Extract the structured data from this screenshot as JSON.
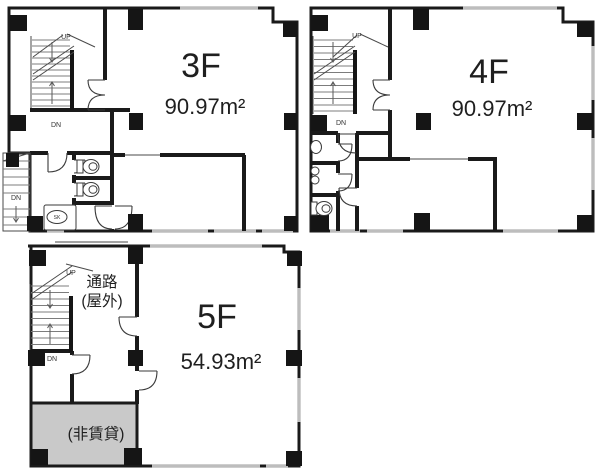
{
  "colors": {
    "wall": "#1a1a1a",
    "window": "#bdbdbd",
    "non_rental_fill": "#c9c9c9",
    "text": "#1f1f1f"
  },
  "floors": {
    "f3": {
      "label": "3F",
      "area": "90.97m²",
      "up": "UP",
      "down": "DN",
      "down_ext": "DN",
      "sink_label": "SK"
    },
    "f4": {
      "label": "4F",
      "area": "90.97m²",
      "up": "UP",
      "down": "DN"
    },
    "f5": {
      "label": "5F",
      "area": "54.93m²",
      "up": "UP",
      "down": "DN",
      "passage_line1": "通路",
      "passage_line2": "(屋外)",
      "non_rental": "(非賃貸)"
    }
  }
}
